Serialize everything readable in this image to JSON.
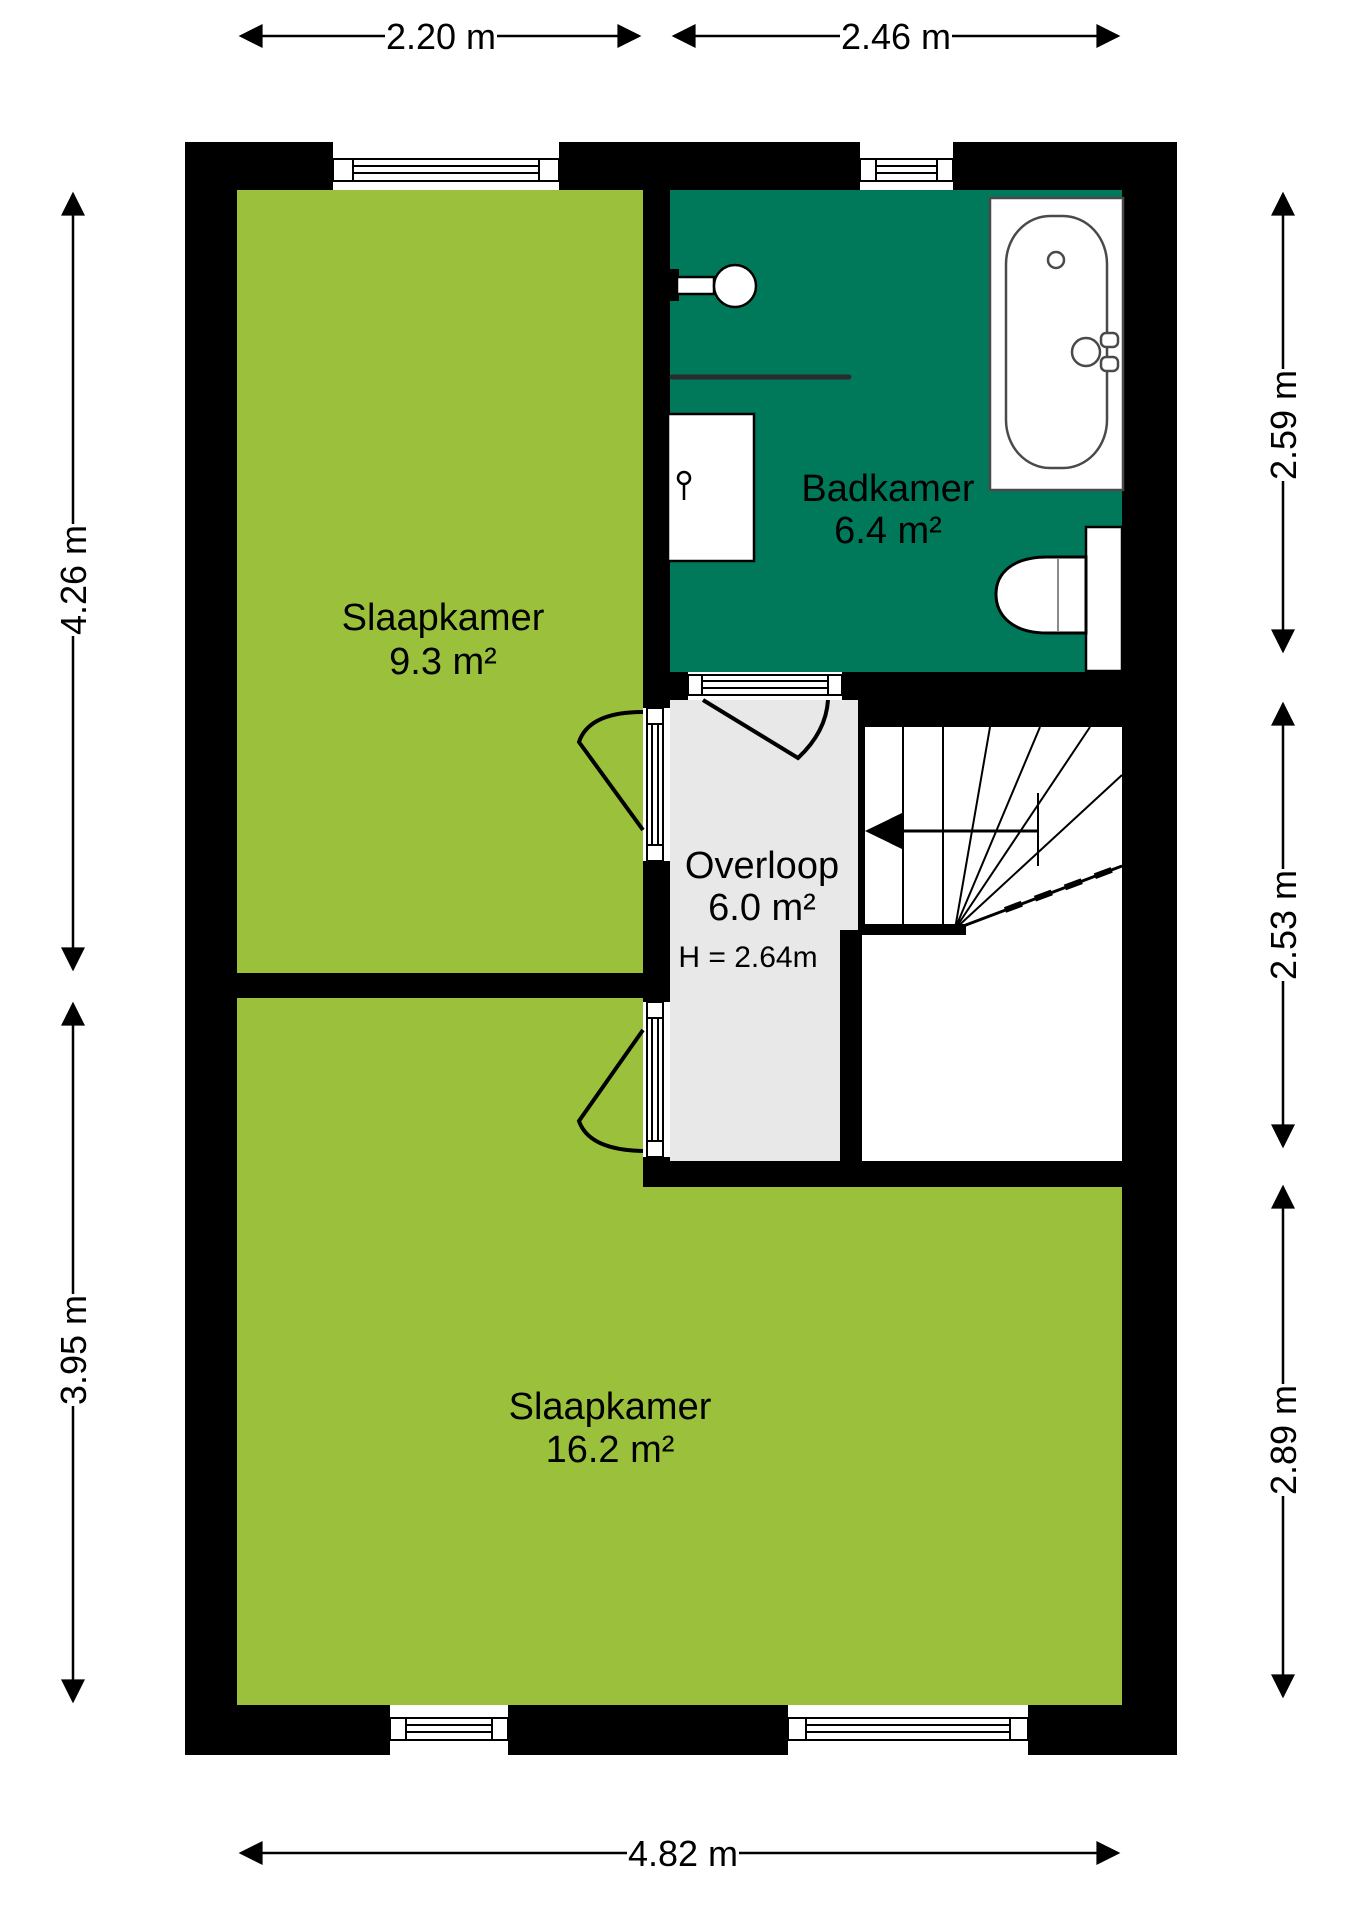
{
  "floorplan": {
    "rooms": [
      {
        "id": "bedroom-small",
        "name": "Slaapkamer",
        "area": "9.3 m²"
      },
      {
        "id": "bathroom",
        "name": "Badkamer",
        "area": "6.4 m²"
      },
      {
        "id": "landing",
        "name": "Overloop",
        "area": "6.0 m²",
        "ceiling_height": "H = 2.64m"
      },
      {
        "id": "bedroom-large",
        "name": "Slaapkamer",
        "area": "16.2 m²"
      }
    ],
    "dimensions": {
      "top": [
        "2.20 m",
        "2.46 m"
      ],
      "right": [
        "2.59 m",
        "2.53 m",
        "2.89 m"
      ],
      "left": [
        "4.26 m",
        "3.95 m"
      ],
      "bottom": [
        "4.82 m"
      ]
    },
    "colors": {
      "bedroom": "#9bc13c",
      "bathroom": "#00795b",
      "landing": "#e8e8e8",
      "wall": "#000000",
      "background": "#ffffff"
    }
  }
}
